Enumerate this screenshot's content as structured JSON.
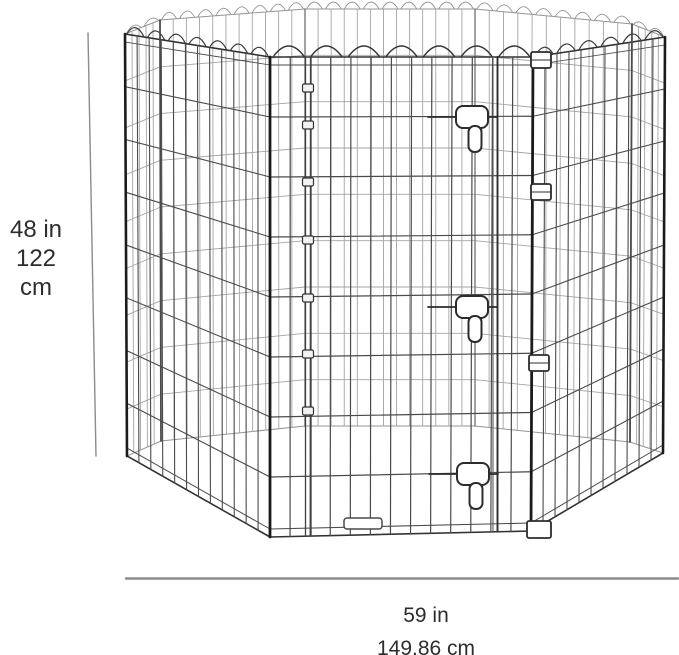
{
  "illustration": {
    "name": "octagonal-wire-pet-playpen",
    "description": "8-panel folding wire pet exercise pen with flip-latch door"
  },
  "dimensions": {
    "height": {
      "inches": "48 in",
      "centimeters": "122 cm"
    },
    "width": {
      "inches": "59 in",
      "centimeters": "149.86 cm"
    }
  },
  "colors": {
    "background": "#ffffff",
    "wire_front": "#4a4a4a",
    "wire_front_edge": "#323232",
    "wire_back": "#a4a4a4",
    "wire_back_edge": "#949494",
    "post_dark": "#1b1b1b",
    "post_mid": "#4a4a4a",
    "post_far": "#7a7a7a",
    "hardware_stroke": "#2c2c2c",
    "hardware_fill": "#ffffff",
    "dimension_line": "#8c8c8c",
    "text": "#2d2d2d"
  }
}
